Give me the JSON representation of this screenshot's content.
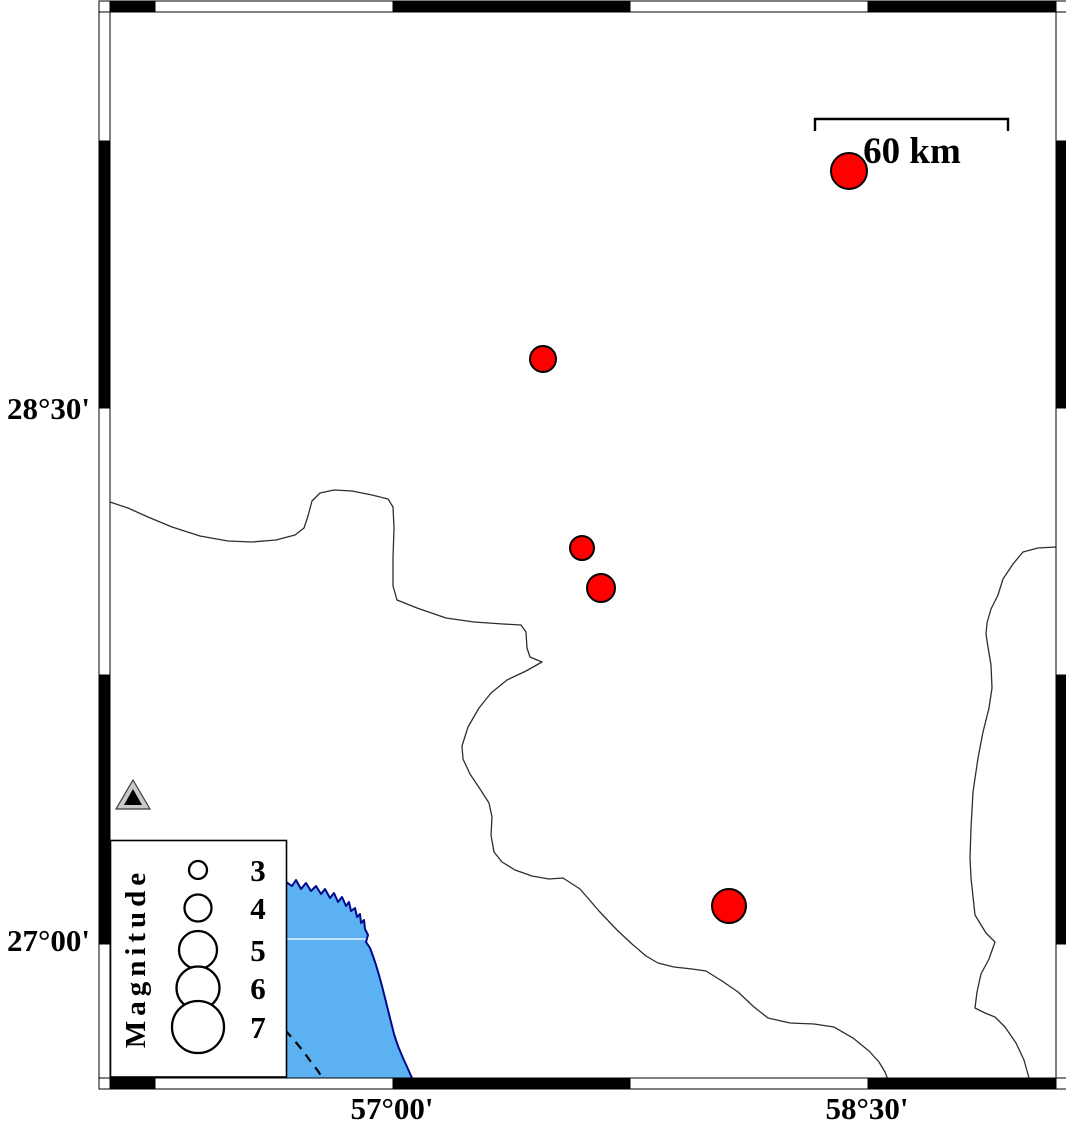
{
  "map": {
    "description": "Seismicity map with magnitude-scaled epicenter symbols",
    "axis": {
      "left_labels": [
        {
          "text": "28°30'",
          "y": 408
        },
        {
          "text": "27°00'",
          "y": 940
        }
      ],
      "bottom_labels": [
        {
          "text": "57°00'",
          "x": 392
        },
        {
          "text": "58°30'",
          "x": 867
        }
      ]
    },
    "scale_bar": {
      "label": "60 km",
      "x1": 815,
      "x2": 1008,
      "y": 119,
      "tick_drop": 12,
      "label_x": 912,
      "label_y": 163
    },
    "frame": {
      "inner": [
        110,
        12,
        1056,
        1078
      ],
      "thickness": 11,
      "x_transitions": [
        110,
        155,
        393,
        630,
        868,
        1056
      ],
      "x_first_black": true,
      "y_transitions": [
        12,
        141,
        408,
        675,
        944,
        1078
      ],
      "y_first_black": false
    },
    "earthquakes": [
      {
        "cx": 849,
        "cy": 171,
        "r": 18
      },
      {
        "cx": 543,
        "cy": 359,
        "r": 13
      },
      {
        "cx": 582,
        "cy": 548,
        "r": 12
      },
      {
        "cx": 601,
        "cy": 588,
        "r": 14
      },
      {
        "cx": 729,
        "cy": 906,
        "r": 17
      }
    ],
    "station": {
      "outer": [
        [
          133,
          780
        ],
        [
          116,
          809
        ],
        [
          150,
          809
        ]
      ],
      "inner": [
        [
          133,
          789
        ],
        [
          124,
          805
        ],
        [
          142,
          805
        ]
      ]
    },
    "legend": {
      "title": "Magnitude",
      "box": {
        "x": 110,
        "y": 840,
        "w": 176,
        "h": 237
      },
      "circle_cx": 198,
      "number_x": 258,
      "entries": [
        {
          "magnitude": "3",
          "cy": 870,
          "r": 9
        },
        {
          "magnitude": "4",
          "cy": 908,
          "r": 13.5
        },
        {
          "magnitude": "5",
          "cy": 950,
          "r": 19
        },
        {
          "magnitude": "6",
          "cy": 988,
          "r": 21.5
        },
        {
          "magnitude": "7",
          "cy": 1027,
          "r": 26
        }
      ]
    },
    "boundaries": {
      "west": [
        [
          110,
          502
        ],
        [
          128,
          508
        ],
        [
          148,
          517
        ],
        [
          172,
          527
        ],
        [
          200,
          536
        ],
        [
          228,
          541
        ],
        [
          252,
          542
        ],
        [
          276,
          540
        ],
        [
          295,
          535
        ],
        [
          304,
          528
        ],
        [
          308,
          516
        ],
        [
          312,
          501
        ],
        [
          320,
          493
        ],
        [
          334,
          490
        ],
        [
          352,
          491
        ],
        [
          372,
          495
        ],
        [
          388,
          499
        ],
        [
          393,
          507
        ],
        [
          394,
          528
        ],
        [
          393,
          558
        ],
        [
          393,
          586
        ],
        [
          397,
          600
        ],
        [
          417,
          608
        ],
        [
          446,
          618
        ],
        [
          474,
          622
        ],
        [
          503,
          624
        ],
        [
          521,
          625
        ],
        [
          526,
          632
        ],
        [
          527,
          648
        ],
        [
          530,
          657
        ],
        [
          542,
          662
        ],
        [
          526,
          671
        ],
        [
          507,
          680
        ],
        [
          491,
          693
        ],
        [
          479,
          708
        ],
        [
          468,
          727
        ],
        [
          462,
          746
        ],
        [
          463,
          759
        ],
        [
          470,
          774
        ],
        [
          480,
          789
        ],
        [
          489,
          803
        ],
        [
          492,
          817
        ],
        [
          491,
          835
        ],
        [
          494,
          852
        ],
        [
          502,
          862
        ],
        [
          515,
          870
        ],
        [
          532,
          876
        ],
        [
          549,
          879
        ],
        [
          563,
          878
        ],
        [
          580,
          889
        ],
        [
          599,
          911
        ],
        [
          617,
          930
        ],
        [
          632,
          944
        ],
        [
          646,
          956
        ],
        [
          658,
          963
        ],
        [
          674,
          967
        ],
        [
          692,
          969
        ],
        [
          706,
          971
        ],
        [
          722,
          981
        ],
        [
          738,
          992
        ],
        [
          754,
          1007
        ],
        [
          768,
          1018
        ],
        [
          790,
          1023
        ],
        [
          814,
          1024
        ],
        [
          834,
          1027
        ],
        [
          853,
          1038
        ],
        [
          869,
          1051
        ],
        [
          879,
          1062
        ],
        [
          885,
          1072
        ],
        [
          888,
          1080
        ]
      ],
      "east": [
        [
          1056,
          547
        ],
        [
          1038,
          548
        ],
        [
          1023,
          552
        ],
        [
          1013,
          564
        ],
        [
          1003,
          579
        ],
        [
          998,
          595
        ],
        [
          991,
          609
        ],
        [
          987,
          623
        ],
        [
          986,
          634
        ],
        [
          988,
          647
        ],
        [
          991,
          665
        ],
        [
          992,
          688
        ],
        [
          989,
          708
        ],
        [
          983,
          732
        ],
        [
          978,
          758
        ],
        [
          973,
          792
        ],
        [
          971,
          828
        ],
        [
          970,
          858
        ],
        [
          971,
          878
        ],
        [
          975,
          915
        ],
        [
          986,
          933
        ],
        [
          995,
          942
        ],
        [
          989,
          959
        ],
        [
          981,
          974
        ],
        [
          977,
          992
        ],
        [
          975,
          1008
        ],
        [
          985,
          1013
        ],
        [
          995,
          1017
        ],
        [
          1005,
          1027
        ],
        [
          1016,
          1043
        ],
        [
          1024,
          1060
        ],
        [
          1029,
          1078
        ]
      ]
    },
    "coastline": [
      [
        286,
        882
      ],
      [
        292,
        886
      ],
      [
        296,
        880
      ],
      [
        301,
        889
      ],
      [
        306,
        883
      ],
      [
        311,
        891
      ],
      [
        316,
        886
      ],
      [
        321,
        894
      ],
      [
        325,
        889
      ],
      [
        330,
        898
      ],
      [
        334,
        893
      ],
      [
        338,
        902
      ],
      [
        342,
        897
      ],
      [
        346,
        906
      ],
      [
        349,
        902
      ],
      [
        351,
        911
      ],
      [
        355,
        908
      ],
      [
        357,
        917
      ],
      [
        360,
        914
      ],
      [
        361,
        923
      ],
      [
        364,
        920
      ],
      [
        365,
        929
      ],
      [
        368,
        935
      ],
      [
        366,
        942
      ],
      [
        370,
        948
      ],
      [
        373,
        956
      ],
      [
        376,
        965
      ],
      [
        379,
        975
      ],
      [
        382,
        986
      ],
      [
        385,
        998
      ],
      [
        388,
        1010
      ],
      [
        391,
        1022
      ],
      [
        394,
        1034
      ],
      [
        398,
        1046
      ],
      [
        403,
        1058
      ],
      [
        408,
        1069
      ],
      [
        412,
        1078
      ]
    ],
    "sea_pre_points": [
      [
        110,
        876
      ]
    ],
    "sea_post_points": [
      [
        412,
        1080
      ],
      [
        110,
        1080
      ]
    ],
    "dashed_contour": [
      [
        285,
        1030
      ],
      [
        294,
        1040
      ],
      [
        303,
        1051
      ],
      [
        311,
        1062
      ],
      [
        318,
        1071
      ],
      [
        323,
        1079
      ]
    ],
    "sea_gridline": {
      "y": 939,
      "x1": 111,
      "x2": 366
    },
    "colors": {
      "earthquake_fill": "#ff0000",
      "earthquake_stroke": "#000000",
      "sea_fill": "#5cb1f2",
      "coast_stroke": "#000a8c",
      "boundary_stroke": "#2e2e2e",
      "frame_black": "#000000",
      "frame_white": "#ffffff",
      "station_fill": "#c9c9c9",
      "station_inner": "#000000",
      "legend_circle_stroke": "#000000",
      "gridline": "#e8f2fd"
    }
  }
}
